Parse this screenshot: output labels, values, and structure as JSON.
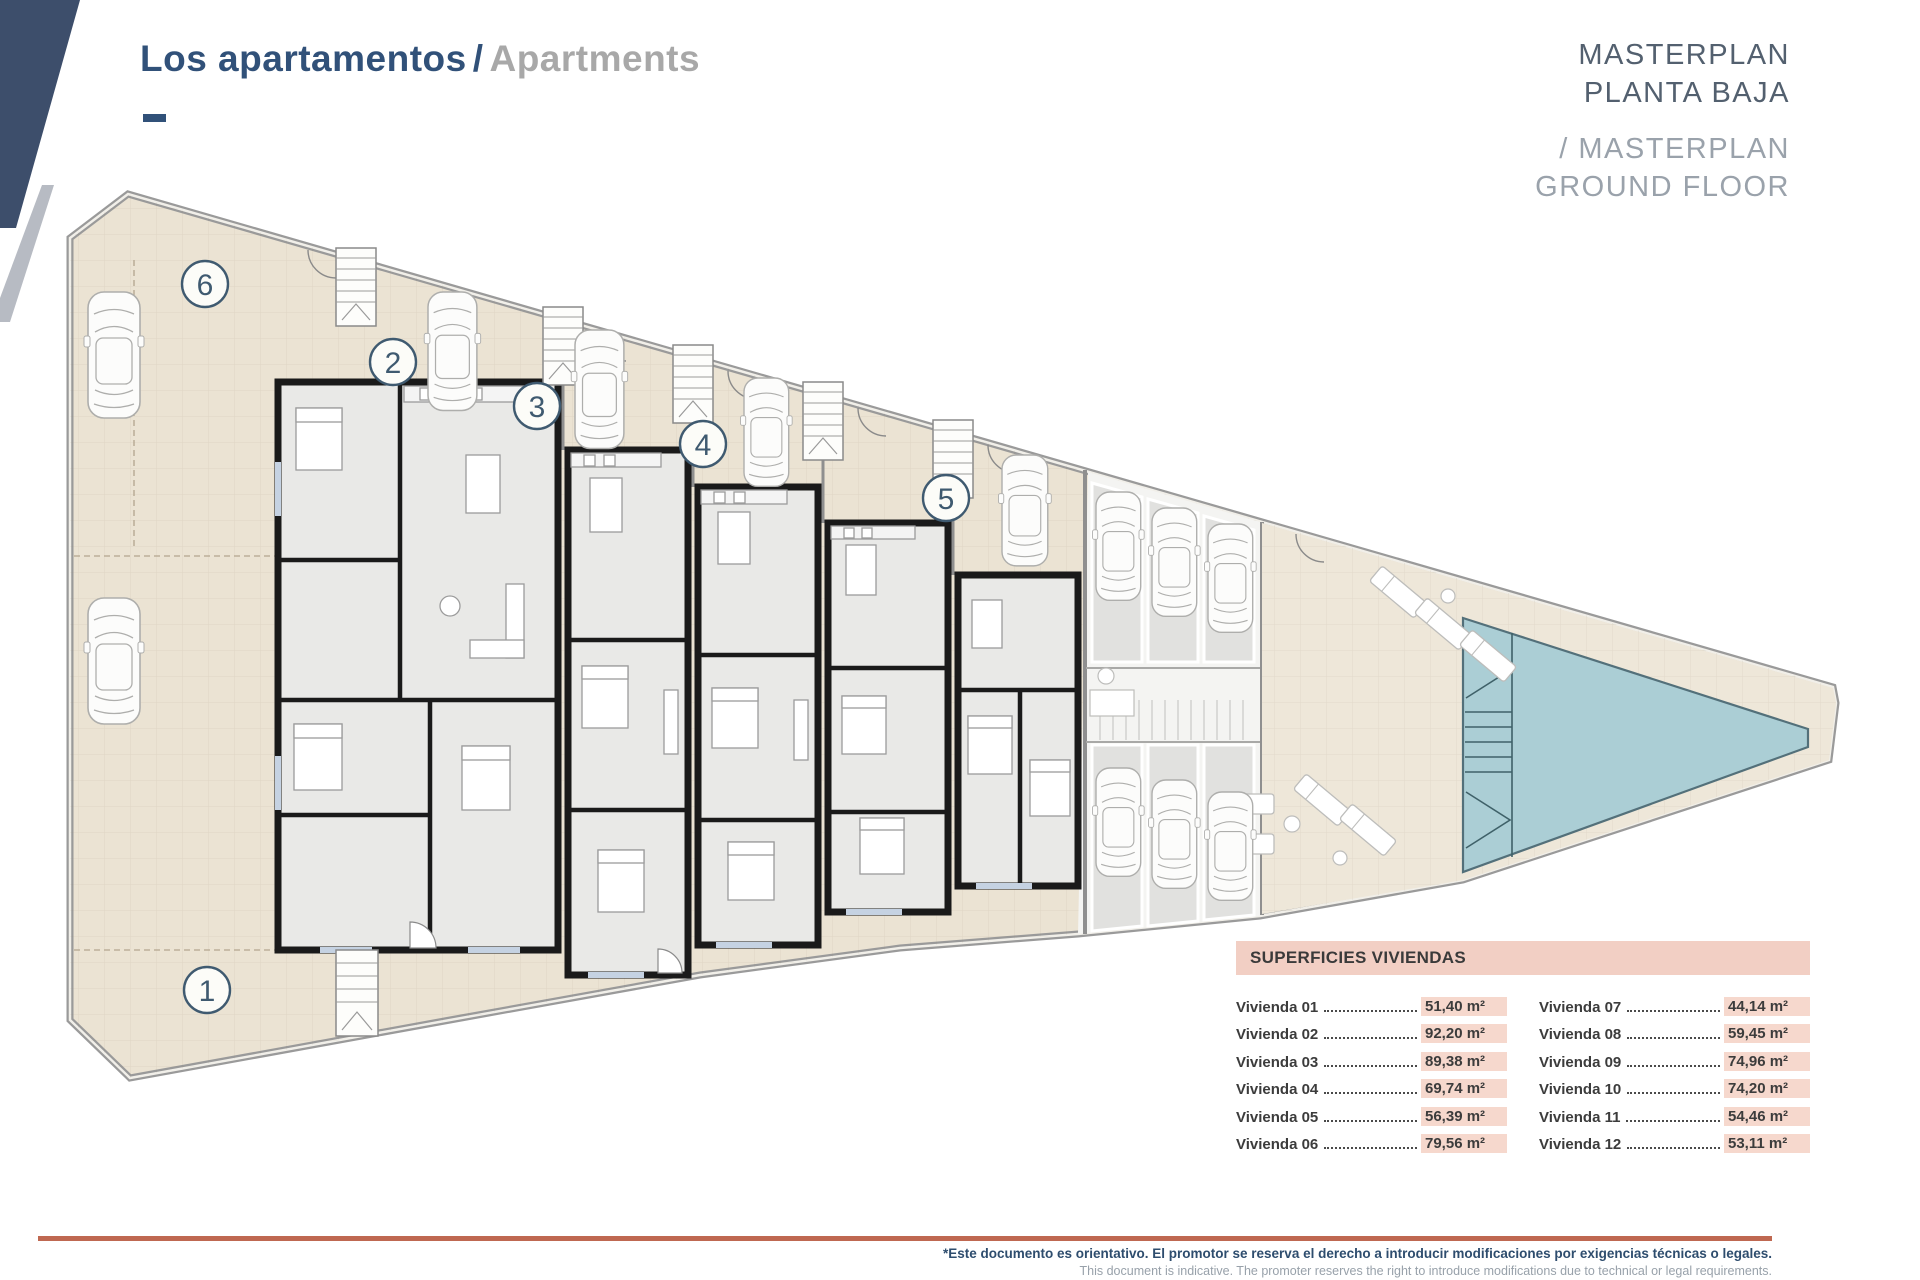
{
  "header": {
    "title_primary": "Los apartamentos",
    "title_divider": "/",
    "title_secondary": "Apartments"
  },
  "masterplan": {
    "line1": "MASTERPLAN",
    "line2": "PLANTA BAJA",
    "line3": "/ MASTERPLAN",
    "line4": "GROUND FLOOR"
  },
  "plan": {
    "units": [
      {
        "label": "1"
      },
      {
        "label": "2"
      },
      {
        "label": "3"
      },
      {
        "label": "4"
      },
      {
        "label": "5"
      },
      {
        "label": "6"
      }
    ],
    "features": {
      "pool": "swimming-pool",
      "parking": "communal-parking-stalls",
      "stairs": "staircases",
      "cars": "parked-cars",
      "loungers": "sun-loungers"
    }
  },
  "areas_table": {
    "title": "SUPERFICIES VIVIENDAS",
    "left_rows": [
      {
        "name": "Vivienda 01",
        "value": "51,40 m²"
      },
      {
        "name": "Vivienda 02",
        "value": "92,20 m²"
      },
      {
        "name": "Vivienda 03",
        "value": "89,38 m²"
      },
      {
        "name": "Vivienda 04",
        "value": "69,74 m²"
      },
      {
        "name": "Vivienda 05",
        "value": "56,39 m²"
      },
      {
        "name": "Vivienda 06",
        "value": "79,56 m²"
      }
    ],
    "right_rows": [
      {
        "name": "Vivienda 07",
        "value": "44,14 m²"
      },
      {
        "name": "Vivienda 08",
        "value": "59,45 m²"
      },
      {
        "name": "Vivienda 09",
        "value": "74,96 m²"
      },
      {
        "name": "Vivienda 10",
        "value": "74,20 m²"
      },
      {
        "name": "Vivienda 11",
        "value": "54,46 m²"
      },
      {
        "name": "Vivienda 12",
        "value": "53,11 m²"
      }
    ]
  },
  "footer": {
    "disclaimer_primary": "*Este documento es orientativo. El promotor se reserva el derecho a introducir modificaciones por exigencias técnicas o legales.",
    "disclaimer_secondary": "This document is indicative. The promoter reserves the right to introduce modifications due to technical or legal requirements."
  },
  "colors": {
    "navy": "#315179",
    "corner_band": "#3d4e6b",
    "gray_text": "#a8a8a8",
    "masterplan_dark": "#53606f",
    "masterplan_light": "#9aa2ab",
    "table_header_bg": "#f2cfc4",
    "value_highlight_bg": "#f6d8cd",
    "footer_line": "#bf6851",
    "terrace_beige": "#ebe3d3",
    "interior_gray": "#e9e9e7",
    "pool_teal": "#abced5",
    "wall_black": "#1a1a1a",
    "wall_gray": "#9a9a9a"
  }
}
